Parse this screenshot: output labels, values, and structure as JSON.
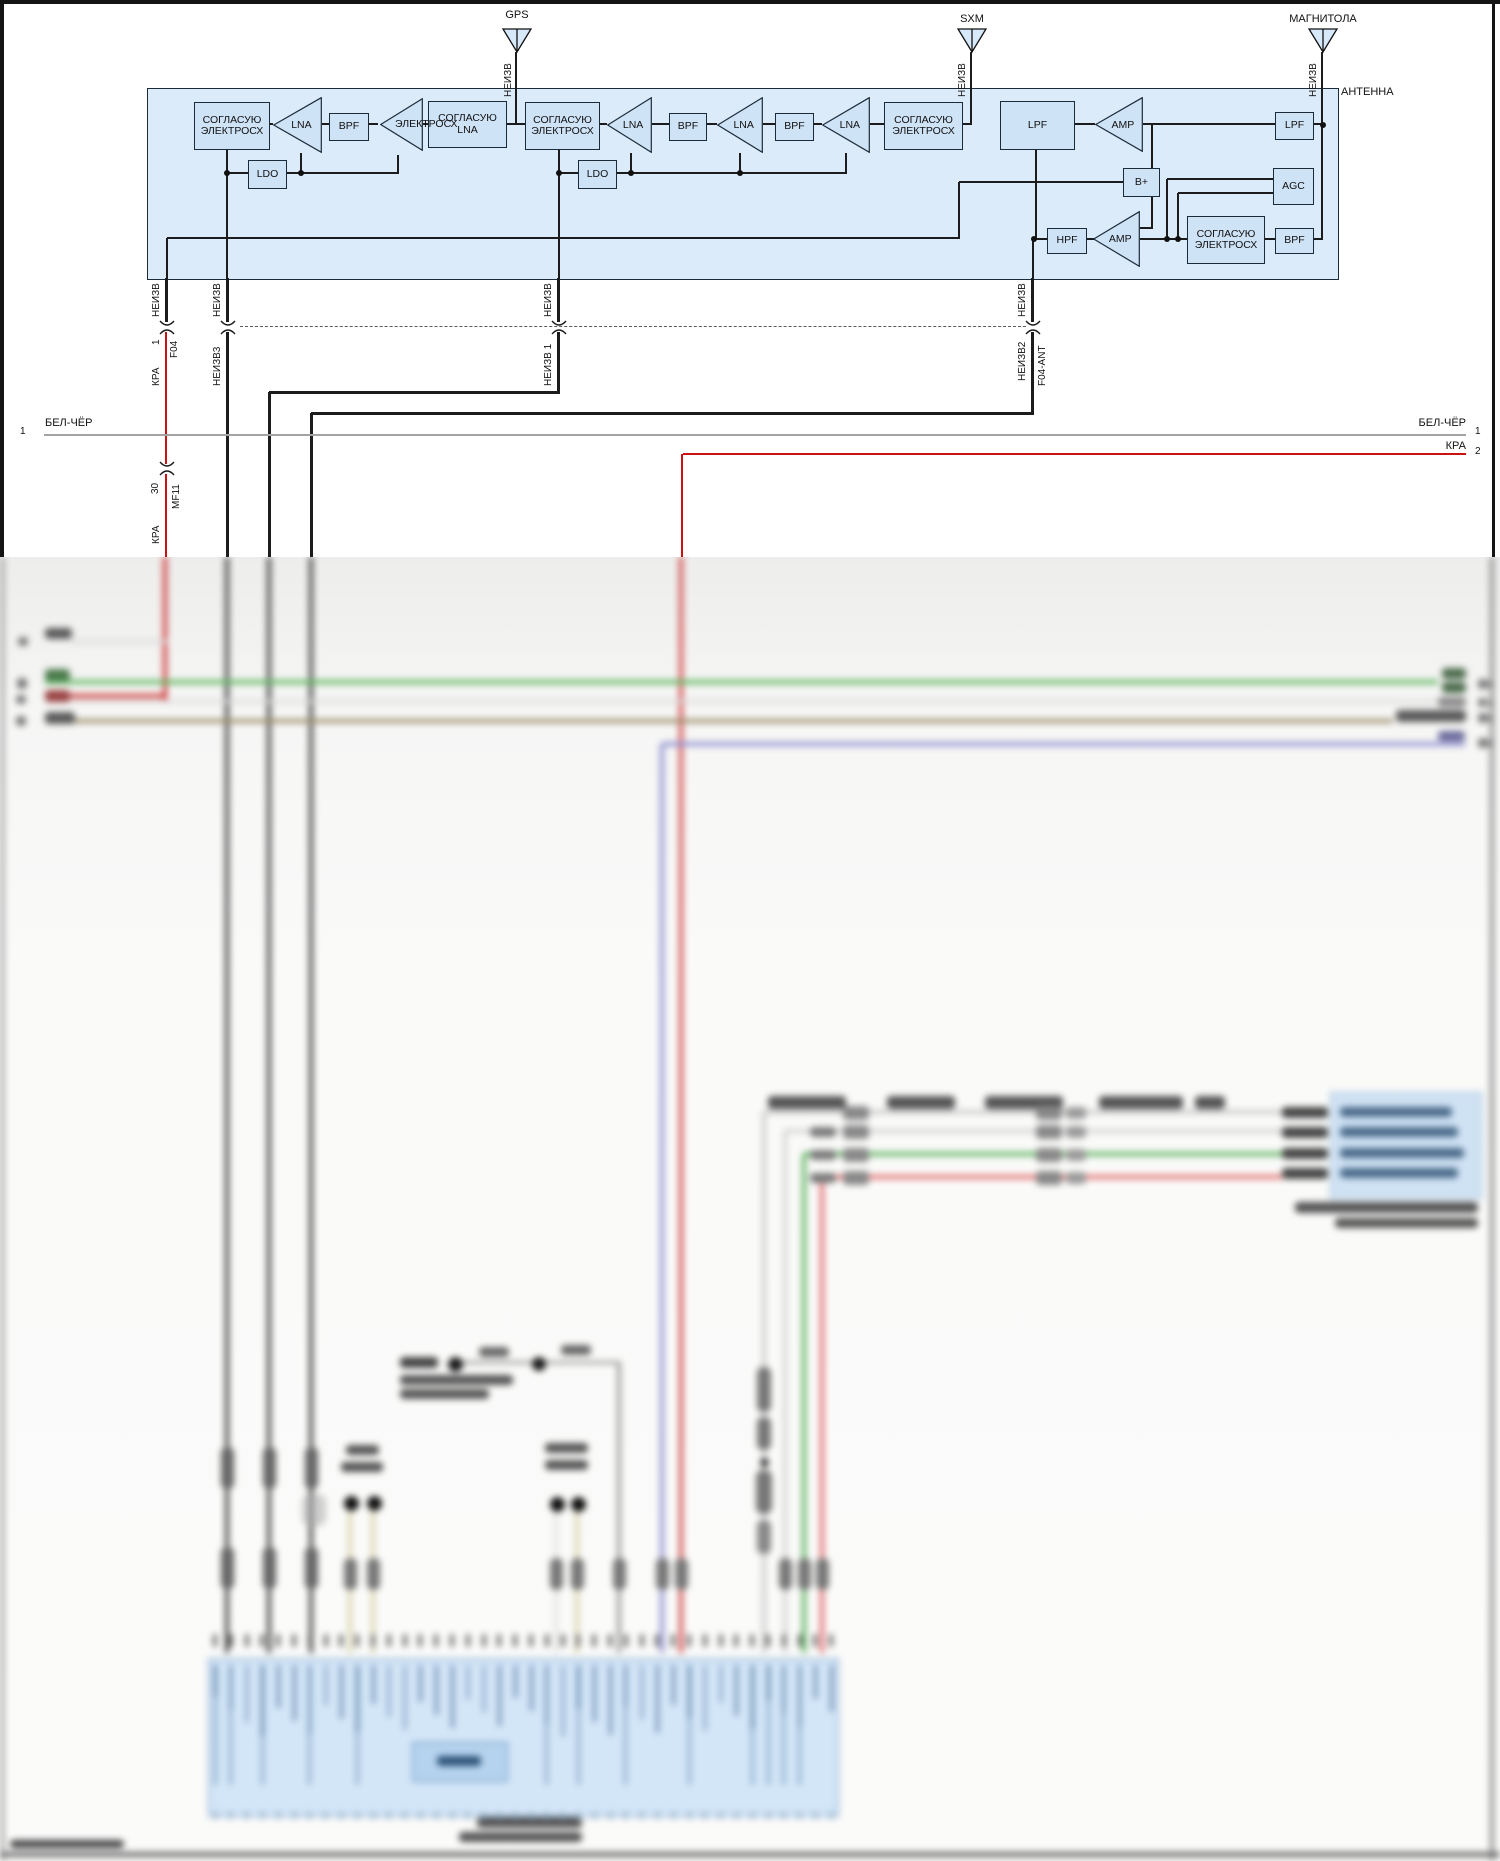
{
  "labels": {
    "gps": "GPS",
    "sxm": "SXM",
    "magnitola": "МАГНИТОЛА",
    "antenna_unit": "АНТЕННА",
    "bplus": "B+",
    "bus1_left_num": "1",
    "bus1_left": "БЕЛ-ЧЁР",
    "bus1_right": "БЕЛ-ЧЁР",
    "bus1_right_num": "1",
    "bus2_right": "КРА",
    "bus2_right_num": "2"
  },
  "colors": {
    "panel_fill": "#dcebfa",
    "block_fill": "#cfe3f7",
    "line": "#1c1c1c",
    "wire_red": "#cc1111",
    "wire_green": "#5cb55c",
    "wire_brown": "#9a8b68",
    "wire_violet": "#8f8fd0",
    "wire_pink": "#e06868",
    "wire_tan": "#d9d3ab",
    "bus_gray": "#a3a3a3",
    "blue_box_fill": "#d3e6f8"
  },
  "shapes_sharp": [
    [
      "box",
      147,
      88,
      1190,
      190,
      "#dcebfa",
      "#1c2b3a",
      1.5
    ],
    [
      "hl",
      268,
      124,
      5
    ],
    [
      "hl",
      322,
      124,
      7
    ],
    [
      "hl",
      367,
      124,
      11
    ],
    [
      "hl",
      423,
      124,
      5
    ],
    [
      "hl",
      505,
      124,
      20
    ],
    [
      "hl",
      598,
      124,
      9
    ],
    [
      "hl",
      652,
      124,
      17
    ],
    [
      "hl",
      705,
      124,
      12
    ],
    [
      "hl",
      763,
      124,
      12
    ],
    [
      "hl",
      812,
      124,
      10
    ],
    [
      "hl",
      870,
      124,
      14
    ],
    [
      "hl",
      961,
      124,
      11
    ],
    [
      "hl",
      1073,
      124,
      22
    ],
    [
      "hl",
      1143,
      124,
      132
    ],
    [
      "hl",
      1312,
      124,
      11
    ],
    [
      "vl",
      516,
      52,
      73,
      2.5
    ],
    [
      "vl",
      971,
      52,
      73,
      2.5
    ],
    [
      "vl",
      1322,
      52,
      73,
      2.5
    ],
    [
      "vl",
      1322,
      124,
      116
    ],
    [
      "hl",
      1312,
      239,
      11
    ],
    [
      "hl",
      227,
      173,
      21
    ],
    [
      "hl",
      285,
      173,
      113
    ],
    [
      "vl",
      227,
      148,
      130
    ],
    [
      "vl",
      301,
      153,
      21
    ],
    [
      "vl",
      398,
      155,
      19
    ],
    [
      "hl",
      559,
      173,
      19
    ],
    [
      "hl",
      615,
      173,
      231
    ],
    [
      "vl",
      559,
      148,
      130
    ],
    [
      "vl",
      631,
      153,
      21
    ],
    [
      "vl",
      740,
      153,
      21
    ],
    [
      "vl",
      846,
      153,
      21
    ],
    [
      "vl",
      167,
      238,
      40
    ],
    [
      "hl",
      167,
      238,
      792
    ],
    [
      "vl",
      959,
      182,
      57
    ],
    [
      "hl",
      959,
      182,
      164
    ],
    [
      "vl",
      1152,
      124,
      45
    ],
    [
      "vl",
      1152,
      195,
      34
    ],
    [
      "hl",
      1140,
      228,
      13
    ],
    [
      "hl",
      1167,
      179,
      106
    ],
    [
      "vl",
      1167,
      179,
      61
    ],
    [
      "hl",
      1178,
      193,
      95
    ],
    [
      "vl",
      1178,
      193,
      47
    ],
    [
      "hl",
      1033,
      239,
      14
    ],
    [
      "hl",
      1085,
      239,
      9
    ],
    [
      "hl",
      1140,
      239,
      47
    ],
    [
      "hl",
      1263,
      239,
      12
    ],
    [
      "vl",
      1036,
      148,
      92
    ],
    [
      "vl",
      1033,
      239,
      39
    ],
    [
      "blk",
      194,
      102,
      74,
      46,
      [
        "СОГЛАСУЮ",
        "ЭЛЕКТРОСХ"
      ]
    ],
    [
      "tri",
      273,
      97,
      49,
      56,
      "LNA"
    ],
    [
      "blk",
      329,
      113,
      38,
      26,
      [
        "BPF"
      ]
    ],
    [
      "tri",
      380,
      98,
      43,
      53,
      ""
    ],
    [
      "blk",
      428,
      101,
      77,
      45,
      [
        "СОГЛАСУЮ",
        "LNA"
      ]
    ],
    [
      "txt",
      395,
      118,
      "ЭЛЕКТРОСХ",
      10.5,
      "l"
    ],
    [
      "blk",
      525,
      102,
      73,
      46,
      [
        "СОГЛАСУЮ",
        "ЭЛЕКТРОСХ"
      ]
    ],
    [
      "tri",
      607,
      97,
      45,
      56,
      "LNA"
    ],
    [
      "blk",
      669,
      113,
      36,
      26,
      [
        "BPF"
      ]
    ],
    [
      "tri",
      717,
      97,
      46,
      56,
      "LNA"
    ],
    [
      "blk",
      775,
      113,
      37,
      26,
      [
        "BPF"
      ]
    ],
    [
      "tri",
      822,
      97,
      48,
      56,
      "LNA"
    ],
    [
      "blk",
      884,
      102,
      77,
      46,
      [
        "СОГЛАСУЮ",
        "ЭЛЕКТРОСХ"
      ]
    ],
    [
      "blk",
      1000,
      101,
      73,
      47,
      [
        "LPF"
      ]
    ],
    [
      "tri",
      1095,
      97,
      48,
      55,
      "AMP"
    ],
    [
      "blk",
      1275,
      112,
      37,
      26,
      [
        "LPF"
      ]
    ],
    [
      "blk",
      1123,
      168,
      35,
      27,
      [
        "B+"
      ]
    ],
    [
      "blk",
      1273,
      168,
      39,
      35,
      [
        "AGC"
      ]
    ],
    [
      "blk",
      248,
      160,
      37,
      27,
      [
        "LDO"
      ]
    ],
    [
      "blk",
      578,
      160,
      37,
      27,
      [
        "LDO"
      ]
    ],
    [
      "blk",
      1047,
      228,
      38,
      24,
      [
        "HPF"
      ]
    ],
    [
      "tri",
      1093,
      211,
      47,
      56,
      "AMP"
    ],
    [
      "blk",
      1187,
      216,
      76,
      46,
      [
        "СОГЛАСУЮ",
        "ЭЛЕКТРОСХ"
      ]
    ],
    [
      "blk",
      1275,
      228,
      37,
      24,
      [
        "BPF"
      ]
    ],
    [
      "dot",
      227,
      173
    ],
    [
      "dot",
      301,
      173
    ],
    [
      "dot",
      559,
      173
    ],
    [
      "dot",
      631,
      173
    ],
    [
      "dot",
      740,
      173
    ],
    [
      "dot",
      1323,
      125
    ],
    [
      "dot",
      1034,
      239
    ],
    [
      "dot",
      1167,
      239
    ],
    [
      "dot",
      1178,
      239
    ],
    [
      "ant",
      517,
      28
    ],
    [
      "ant",
      972,
      28
    ],
    [
      "ant",
      1323,
      28
    ],
    [
      "vl",
      166,
      278,
      44,
      3
    ],
    [
      "vl",
      227,
      278,
      44,
      3
    ],
    [
      "vl",
      558,
      278,
      44,
      3
    ],
    [
      "vl",
      1032,
      278,
      44,
      3
    ],
    [
      "brk",
      167,
      327
    ],
    [
      "brk",
      228,
      327
    ],
    [
      "brk",
      559,
      327
    ],
    [
      "brk",
      1033,
      327
    ],
    [
      "vl",
      166,
      332,
      132,
      2.5,
      "#cc1111"
    ],
    [
      "brk",
      167,
      468
    ],
    [
      "vl",
      166,
      474,
      85,
      2.5,
      "#cc1111"
    ],
    [
      "vl",
      227,
      332,
      227,
      3
    ],
    [
      "vl",
      558,
      332,
      61,
      3
    ],
    [
      "hl",
      269,
      392,
      291,
      3
    ],
    [
      "vl",
      269,
      392,
      167,
      3
    ],
    [
      "vl",
      1032,
      332,
      82,
      3
    ],
    [
      "hl",
      311,
      413,
      723,
      3
    ],
    [
      "vl",
      311,
      413,
      146,
      3
    ],
    [
      "dash",
      240,
      327,
      786
    ],
    [
      "hl",
      44,
      435,
      1422,
      1.2,
      "#a3a3a3"
    ],
    [
      "hl",
      683,
      454,
      783,
      2.5,
      "#cc1111"
    ],
    [
      "vl",
      682,
      454,
      105,
      2.5,
      "#cc1111"
    ],
    [
      "vt",
      503,
      97,
      "НЕИЗВ"
    ],
    [
      "vt",
      957,
      97,
      "НЕИЗВ"
    ],
    [
      "vt",
      1308,
      97,
      "НЕИЗВ"
    ],
    [
      "vt",
      151,
      317,
      "НЕИЗВ"
    ],
    [
      "vt",
      151,
      345,
      "1"
    ],
    [
      "vt",
      169,
      358,
      "F04"
    ],
    [
      "vt",
      151,
      386,
      "КРА"
    ],
    [
      "vt",
      212,
      317,
      "НЕИЗВ"
    ],
    [
      "vt",
      212,
      386,
      "НЕИЗВ3"
    ],
    [
      "vt",
      543,
      317,
      "НЕИЗВ"
    ],
    [
      "vt",
      543,
      386,
      "НЕИЗВ 1"
    ],
    [
      "vt",
      1017,
      317,
      "НЕИЗВ"
    ],
    [
      "vt",
      1017,
      381,
      "НЕИЗВ2"
    ],
    [
      "vt",
      1037,
      386,
      "F04-ANT"
    ],
    [
      "vt",
      150,
      494,
      "30"
    ],
    [
      "vt",
      171,
      509,
      "MF11"
    ],
    [
      "vt",
      151,
      544,
      "КРА"
    ]
  ],
  "shapes_blur": [
    [
      "vl",
      2,
      557,
      1304,
      3,
      "#8a8a8a"
    ],
    [
      "vl",
      1492,
      557,
      1304,
      3.5,
      "#8a8a8a"
    ],
    [
      "hl",
      0,
      1854,
      1500,
      5,
      "#6a6a6a"
    ],
    [
      "vl",
      165,
      557,
      143,
      4,
      "#cc3333"
    ],
    [
      "vl",
      227,
      557,
      1096,
      3.5,
      "#3f3f3f"
    ],
    [
      "vl",
      269,
      557,
      1096,
      3.5,
      "#3f3f3f"
    ],
    [
      "vl",
      311,
      557,
      1096,
      3.5,
      "#3f3f3f"
    ],
    [
      "vl",
      681,
      557,
      1096,
      4,
      "#d04545"
    ],
    [
      "vl",
      662,
      744,
      909,
      4,
      "#8f8fd0"
    ],
    [
      "hl",
      70,
      641,
      97,
      3,
      "#d8d8d8"
    ],
    [
      "hl",
      45,
      682,
      1393,
      3.5,
      "#5cb55c"
    ],
    [
      "hl",
      45,
      696,
      122,
      3.5,
      "#cc3333"
    ],
    [
      "hl",
      45,
      701,
      1393,
      3,
      "#d8d8d8"
    ],
    [
      "hl",
      45,
      721,
      1348,
      3.5,
      "#9a8b68"
    ],
    [
      "hl",
      662,
      744,
      803,
      4,
      "#8f8fd0"
    ],
    [
      "hl",
      764,
      1112,
      518,
      4,
      "#c9c9c9"
    ],
    [
      "vl",
      764,
      1112,
      541,
      4,
      "#c9c9c9"
    ],
    [
      "hl",
      785,
      1131,
      497,
      3.5,
      "#d2d2d2"
    ],
    [
      "vl",
      785,
      1131,
      522,
      3.5,
      "#d2d2d2"
    ],
    [
      "hl",
      804,
      1154,
      478,
      3.5,
      "#5ab05a"
    ],
    [
      "vl",
      804,
      1154,
      499,
      3.5,
      "#5ab05a"
    ],
    [
      "hl",
      822,
      1177,
      460,
      3.5,
      "#e06868"
    ],
    [
      "vl",
      822,
      1177,
      476,
      3.5,
      "#e06868"
    ],
    [
      "hl",
      462,
      1362,
      158,
      3,
      "#9a9a9a"
    ],
    [
      "vl",
      619,
      1362,
      291,
      3.5,
      "#9a9a9a"
    ],
    [
      "vl",
      350,
      1509,
      144,
      4,
      "#d9d3ab"
    ],
    [
      "vl",
      373,
      1509,
      144,
      4,
      "#d9d3ab"
    ],
    [
      "vl",
      556,
      1510,
      143,
      4,
      "#e3e3e0"
    ],
    [
      "vl",
      577,
      1510,
      143,
      4,
      "#d9d3ab"
    ],
    [
      "blob",
      45,
      628,
      27,
      11,
      "#5a5a5a"
    ],
    [
      "blob",
      45,
      669,
      25,
      12,
      "#4c7a4c"
    ],
    [
      "blob",
      45,
      690,
      25,
      12,
      "#9a4444"
    ],
    [
      "blob",
      45,
      712,
      30,
      12,
      "#5a5a5a"
    ],
    [
      "blob",
      18,
      637,
      10,
      9,
      "#777"
    ],
    [
      "blob",
      17,
      678,
      10,
      11,
      "#777"
    ],
    [
      "blob",
      16,
      695,
      10,
      9,
      "#777"
    ],
    [
      "blob",
      16,
      716,
      10,
      10,
      "#777"
    ],
    [
      "blob",
      1442,
      668,
      24,
      11,
      "#4c6b4c"
    ],
    [
      "blob",
      1442,
      682,
      24,
      11,
      "#4c6b4c"
    ],
    [
      "blob",
      1438,
      697,
      28,
      10,
      "#8a8a8a"
    ],
    [
      "blob",
      1396,
      710,
      70,
      12,
      "#5a5a5a"
    ],
    [
      "blob",
      1438,
      731,
      27,
      10,
      "#6a6a9a"
    ],
    [
      "blob",
      1478,
      679,
      10,
      10,
      "#777"
    ],
    [
      "blob",
      1478,
      698,
      9,
      9,
      "#777"
    ],
    [
      "blob",
      1478,
      713,
      10,
      10,
      "#777"
    ],
    [
      "blob",
      1478,
      738,
      10,
      10,
      "#777"
    ],
    [
      "blob",
      1489,
      681,
      4,
      7,
      "#666"
    ],
    [
      "blob",
      1489,
      700,
      4,
      7,
      "#666"
    ],
    [
      "blob",
      1489,
      715,
      4,
      7,
      "#666"
    ],
    [
      "blob",
      1489,
      740,
      4,
      7,
      "#666"
    ],
    [
      "blob",
      768,
      1096,
      78,
      13,
      "#555"
    ],
    [
      "blob",
      887,
      1096,
      68,
      13,
      "#555"
    ],
    [
      "blob",
      985,
      1096,
      78,
      13,
      "#555"
    ],
    [
      "blob",
      1099,
      1096,
      84,
      13,
      "#555"
    ],
    [
      "blob",
      1195,
      1096,
      30,
      13,
      "#555"
    ],
    [
      "blob",
      843,
      1106,
      26,
      14,
      "#888"
    ],
    [
      "blob",
      1036,
      1106,
      26,
      14,
      "#888"
    ],
    [
      "blob",
      1066,
      1107,
      20,
      12,
      "#999"
    ],
    [
      "blob",
      843,
      1125,
      26,
      14,
      "#888"
    ],
    [
      "blob",
      1036,
      1125,
      26,
      14,
      "#888"
    ],
    [
      "blob",
      1066,
      1126,
      20,
      12,
      "#999"
    ],
    [
      "blob",
      810,
      1127,
      26,
      10,
      "#777"
    ],
    [
      "blob",
      843,
      1148,
      26,
      14,
      "#888"
    ],
    [
      "blob",
      1036,
      1148,
      26,
      14,
      "#888"
    ],
    [
      "blob",
      1066,
      1149,
      20,
      12,
      "#999"
    ],
    [
      "blob",
      810,
      1150,
      26,
      10,
      "#777"
    ],
    [
      "blob",
      843,
      1171,
      26,
      14,
      "#888"
    ],
    [
      "blob",
      1036,
      1171,
      26,
      14,
      "#888"
    ],
    [
      "blob",
      1066,
      1172,
      20,
      12,
      "#999"
    ],
    [
      "blob",
      810,
      1173,
      26,
      10,
      "#777"
    ],
    [
      "blob",
      1282,
      1107,
      46,
      11,
      "#444"
    ],
    [
      "blob",
      1282,
      1127,
      46,
      11,
      "#444"
    ],
    [
      "blob",
      1282,
      1148,
      46,
      11,
      "#444"
    ],
    [
      "blob",
      1282,
      1168,
      46,
      11,
      "#444"
    ],
    [
      "box",
      1330,
      1092,
      150,
      105,
      "#cfe2f4",
      "#8fb0cc",
      1.5
    ],
    [
      "blob",
      1340,
      1107,
      112,
      10,
      "#4a6a8a"
    ],
    [
      "blob",
      1340,
      1127,
      118,
      10,
      "#4a6a8a"
    ],
    [
      "blob",
      1340,
      1148,
      124,
      10,
      "#4a6a8a"
    ],
    [
      "blob",
      1340,
      1168,
      118,
      10,
      "#4a6a8a"
    ],
    [
      "blob",
      1295,
      1202,
      183,
      11,
      "#555"
    ],
    [
      "blob",
      1335,
      1218,
      143,
      10,
      "#555"
    ],
    [
      "blob",
      400,
      1357,
      38,
      11,
      "#444"
    ],
    [
      "circ",
      455,
      1364,
      15,
      "#1a1a1a"
    ],
    [
      "circ",
      539,
      1364,
      14,
      "#1a1a1a"
    ],
    [
      "blob",
      479,
      1347,
      30,
      10,
      "#666"
    ],
    [
      "blob",
      561,
      1345,
      30,
      10,
      "#666"
    ],
    [
      "blob",
      400,
      1375,
      113,
      10,
      "#555"
    ],
    [
      "blob",
      400,
      1389,
      89,
      10,
      "#555"
    ],
    [
      "blob",
      346,
      1445,
      33,
      10,
      "#555"
    ],
    [
      "blob",
      341,
      1462,
      42,
      10,
      "#555"
    ],
    [
      "circ",
      351,
      1503,
      15,
      "#111"
    ],
    [
      "circ",
      374,
      1503,
      15,
      "#111"
    ],
    [
      "blob",
      545,
      1443,
      43,
      10,
      "#555"
    ],
    [
      "blob",
      545,
      1460,
      43,
      10,
      "#555"
    ],
    [
      "circ",
      557,
      1504,
      15,
      "#111"
    ],
    [
      "circ",
      578,
      1504,
      15,
      "#111"
    ],
    [
      "blob",
      221,
      1447,
      13,
      42,
      "#666",
      6
    ],
    [
      "blob",
      263,
      1447,
      13,
      42,
      "#666",
      6
    ],
    [
      "blob",
      305,
      1447,
      13,
      42,
      "#666",
      6
    ],
    [
      "blob",
      221,
      1547,
      13,
      42,
      "#666",
      6
    ],
    [
      "blob",
      263,
      1547,
      13,
      42,
      "#666",
      6
    ],
    [
      "blob",
      305,
      1547,
      13,
      42,
      "#666",
      6
    ],
    [
      "blob",
      302,
      1494,
      24,
      32,
      "#aaa",
      8,
      0.55
    ],
    [
      "blob",
      344,
      1558,
      13,
      32,
      "#777",
      6
    ],
    [
      "blob",
      367,
      1558,
      13,
      32,
      "#777",
      6
    ],
    [
      "blob",
      550,
      1558,
      13,
      32,
      "#777",
      6
    ],
    [
      "blob",
      571,
      1558,
      13,
      32,
      "#777",
      6
    ],
    [
      "blob",
      613,
      1558,
      13,
      32,
      "#777",
      6
    ],
    [
      "blob",
      656,
      1558,
      13,
      32,
      "#777",
      6
    ],
    [
      "blob",
      675,
      1558,
      13,
      32,
      "#777",
      6
    ],
    [
      "blob",
      779,
      1558,
      13,
      32,
      "#777",
      6
    ],
    [
      "blob",
      798,
      1558,
      13,
      32,
      "#777",
      6
    ],
    [
      "blob",
      816,
      1558,
      13,
      32,
      "#777",
      6
    ],
    [
      "blob",
      757,
      1367,
      14,
      45,
      "#777",
      6
    ],
    [
      "blob",
      757,
      1417,
      14,
      33,
      "#777",
      6
    ],
    [
      "circ",
      764,
      1462,
      9,
      "#333"
    ],
    [
      "blob",
      756,
      1470,
      16,
      44,
      "#777",
      7
    ],
    [
      "blob",
      757,
      1520,
      14,
      34,
      "#888",
      6
    ],
    [
      "box",
      208,
      1658,
      627,
      155,
      "#d3e6f8",
      "#9ab7d6",
      2
    ],
    [
      "box",
      412,
      1742,
      94,
      38,
      "#b5d2ee",
      "#5d87b0",
      1.5
    ],
    [
      "blob",
      437,
      1756,
      44,
      10,
      "#2e5478"
    ],
    [
      "blob",
      477,
      1817,
      105,
      11,
      "#555"
    ],
    [
      "blob",
      459,
      1832,
      123,
      10,
      "#555"
    ],
    [
      "blob",
      10,
      1840,
      114,
      8,
      "#444"
    ]
  ],
  "connector_strip": {
    "x0": 215,
    "dx": 15.8,
    "count": 40,
    "pin_top": 1634,
    "label_top": 1665,
    "pin_bottom": 1811,
    "deep_idx": [
      0,
      1,
      3,
      6,
      9,
      21,
      23,
      26,
      30,
      34,
      35,
      36,
      37
    ]
  }
}
